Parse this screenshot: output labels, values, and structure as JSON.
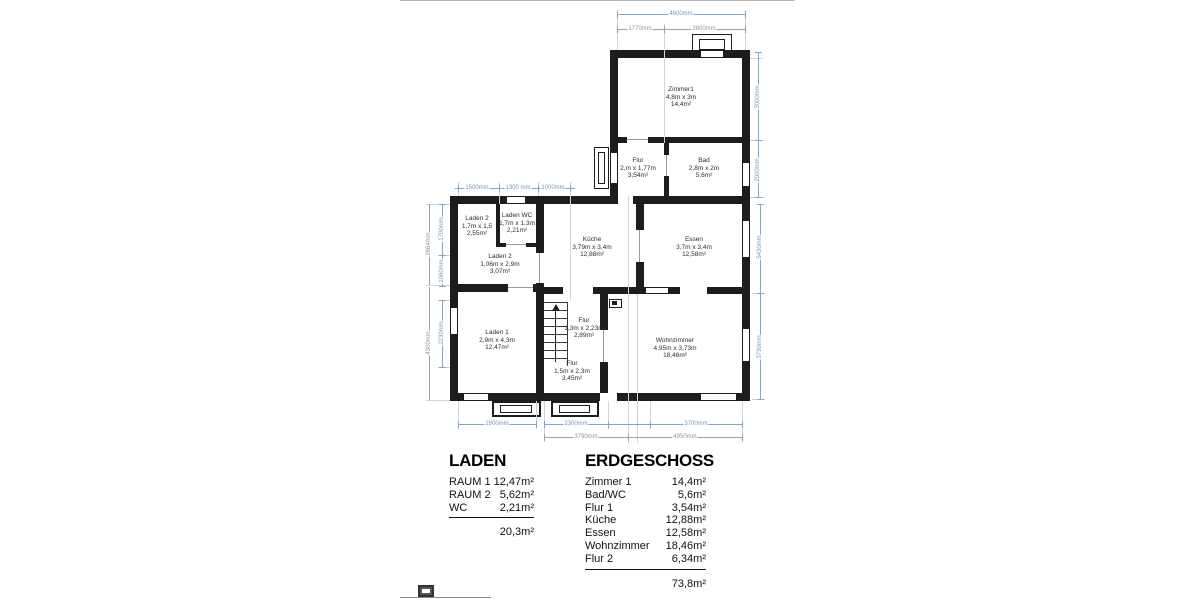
{
  "plan": {
    "rooms": [
      {
        "name": "Zimmer1",
        "dims": "4,8m x 3m",
        "area": "14,4m²"
      },
      {
        "name": "Flur",
        "dims": "2,m x 1,77m",
        "area": "3,54m²"
      },
      {
        "name": "Bad",
        "dims": "2,8m x 2m",
        "area": "5,6m²"
      },
      {
        "name": "Laden 2",
        "dims": "1,7m x 1,5",
        "area": "2,55m²"
      },
      {
        "name": "Laden WC",
        "dims": "1,7m x 1,3m",
        "area": "2,21m²"
      },
      {
        "name": "Laden 2",
        "dims": "1,06m x 2,9m",
        "area": "3,07m²"
      },
      {
        "name": "Küche",
        "dims": "3,79m x 3,4m",
        "area": "12,88m²"
      },
      {
        "name": "Essen",
        "dims": "3,7m x 3,4m",
        "area": "12,58m²"
      },
      {
        "name": "Laden 1",
        "dims": "2,9m x 4,3m",
        "area": "12,47m²"
      },
      {
        "name": "Flur",
        "dims": "1,3m x 2,23m",
        "area": "2,89m²"
      },
      {
        "name": "Flur",
        "dims": "1,5m x 2,3m",
        "area": "3,45m²"
      },
      {
        "name": "Wohnzimmer",
        "dims": "4,95m x 3,73m",
        "area": "18,46m²"
      }
    ],
    "dims": {
      "top_total": "4600mm",
      "top_seg1": "1770mm",
      "top_seg2": "2800mm",
      "right_zimmer": "3000mm",
      "right_bad": "2000mm",
      "right_upper": "5430mm",
      "right_lower": "3730mm",
      "chain_1500": "1500mm",
      "chain_1300": "1300 mm",
      "chain_1000": "1000mm",
      "left_outer_upper": "2664mm",
      "left_1700": "1700mm",
      "left_1060": "1060mm",
      "left_outer_lower": "4300mm",
      "left_2230": "2230mm",
      "bottom_2900": "2900mm",
      "bottom_2300": "2300mm",
      "bottom_3700": "3700mm",
      "bottom_3790": "3790mm",
      "bottom_4950": "4950mm"
    }
  },
  "tables": {
    "laden": {
      "title": "LADEN",
      "rows": [
        {
          "label": "RAUM 1",
          "value": "12,47m²"
        },
        {
          "label": "RAUM 2",
          "value": "5,62m²"
        },
        {
          "label": "WC",
          "value": "2,21m²"
        }
      ],
      "total": "20,3m²"
    },
    "erdgeschoss": {
      "title": "ERDGESCHOSS",
      "rows": [
        {
          "label": "Zimmer 1",
          "value": "14,4m²"
        },
        {
          "label": "Bad/WC",
          "value": "5,6m²"
        },
        {
          "label": "Flur 1",
          "value": "3,54m²"
        },
        {
          "label": "Küche",
          "value": "12,88m²"
        },
        {
          "label": "Essen",
          "value": "12,58m²"
        },
        {
          "label": "Wohnzimmer",
          "value": "18,46m²"
        },
        {
          "label": "Flur 2",
          "value": "6,34m²"
        }
      ],
      "total": "73,8m²"
    }
  },
  "colors": {
    "wall": "#1d1d1b",
    "dimension": "#8fa3b5",
    "text": "#2e2e2e"
  }
}
